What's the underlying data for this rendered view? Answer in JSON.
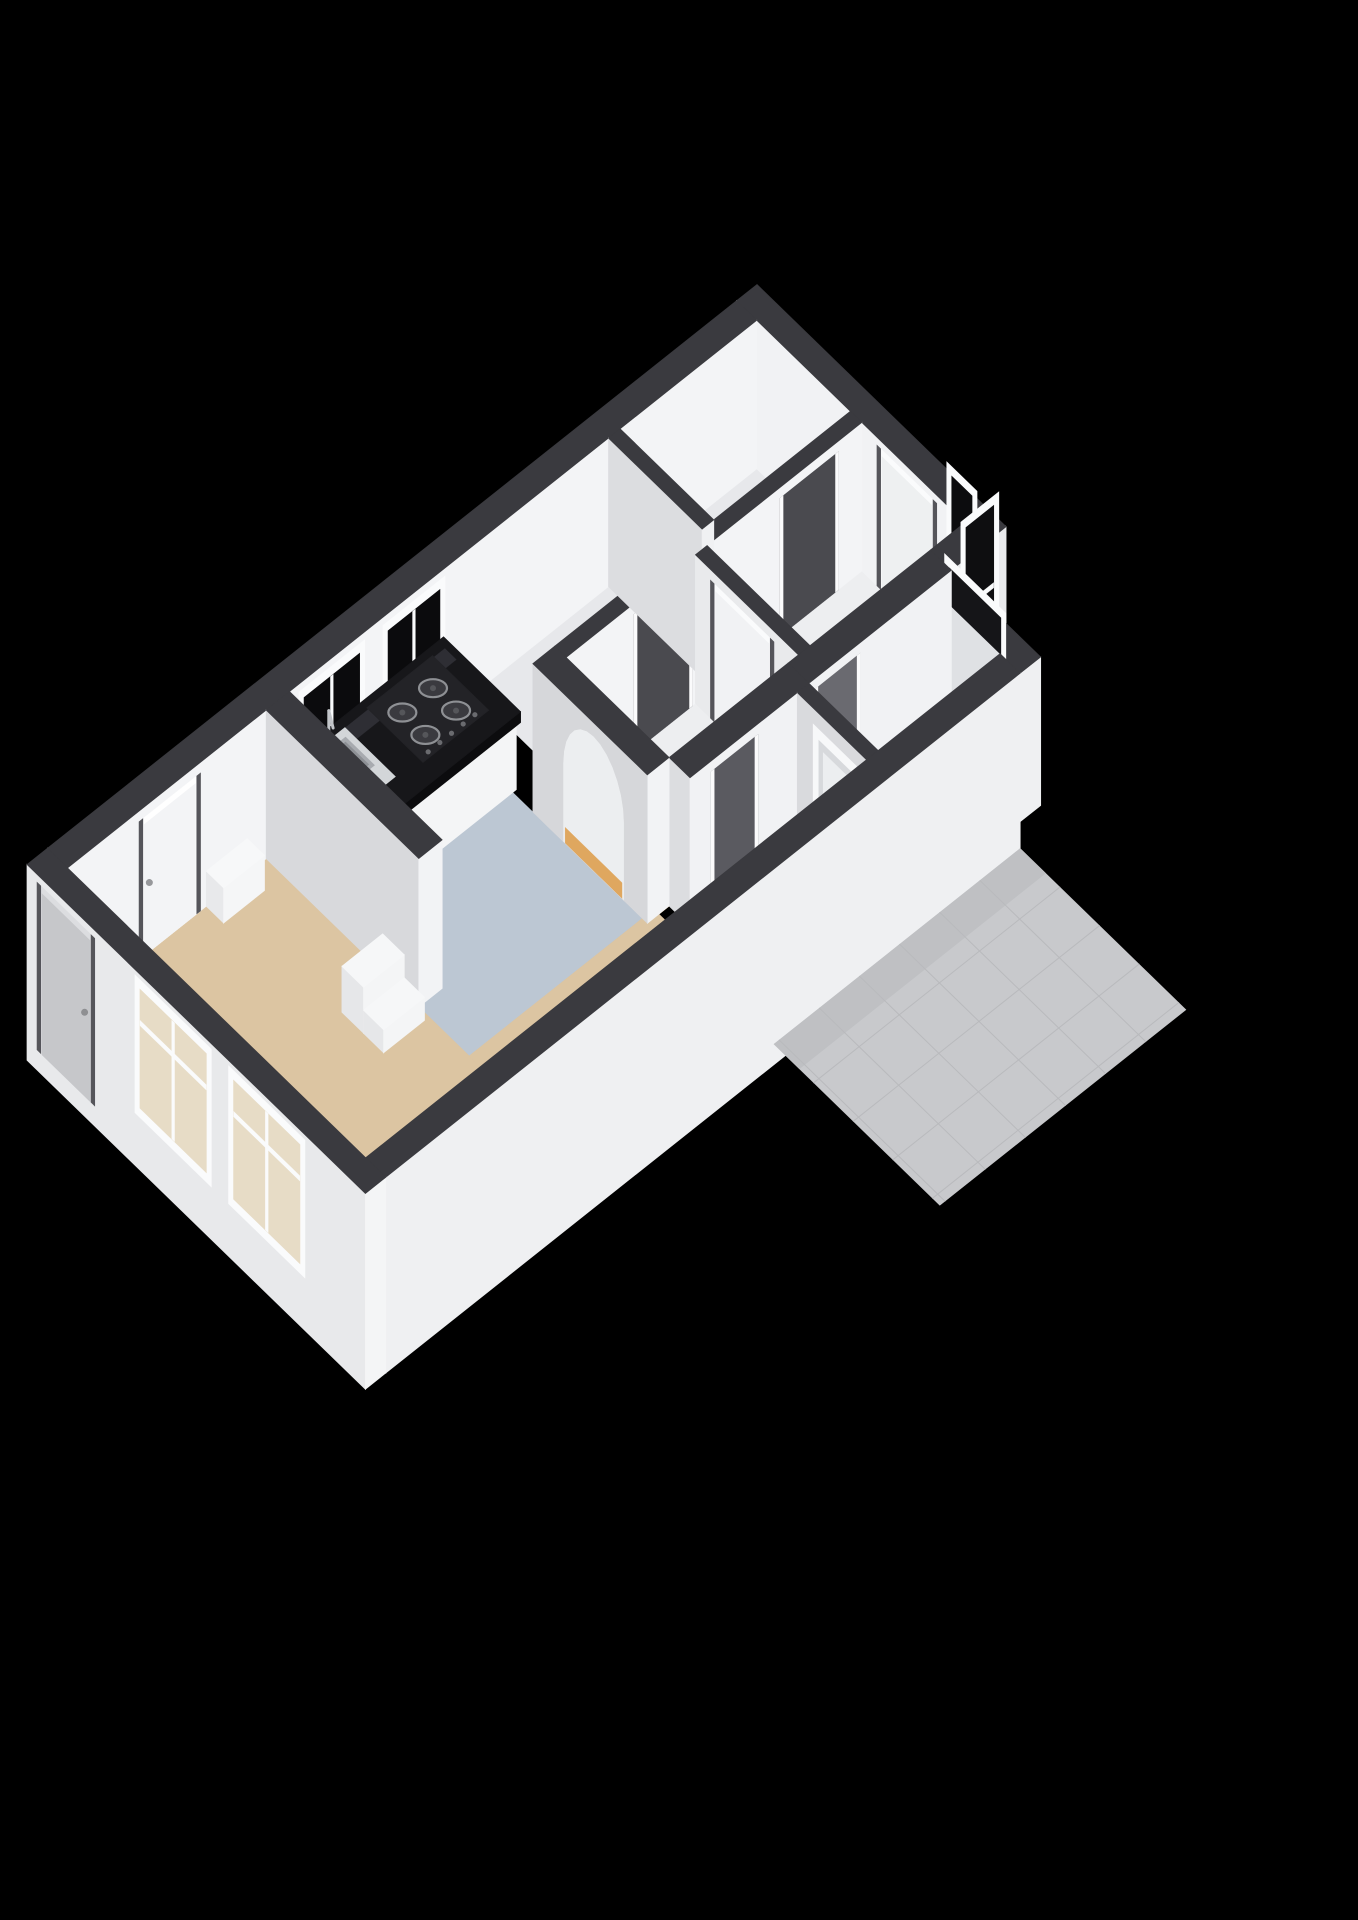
{
  "meta": {
    "description": "3D axonometric floor plan render of an elongated apartment on black background",
    "render_style": "cut-wall 3d floorplan"
  },
  "canvas": {
    "width": 1358,
    "height": 1920,
    "background": "#000000"
  },
  "projection": {
    "origin": [
      757,
      433
    ],
    "u_axis": [
      -0.73,
      0.58
    ],
    "v_axis": [
      0.72,
      0.7
    ],
    "z_scale": 1.35,
    "wall_height": 110
  },
  "palette": {
    "background": "#000000",
    "wall_cap": "#3a3a3f",
    "wall_sw_face": "#dadbde",
    "wall_se_face": "#f3f4f6",
    "floor_living": "#dcc5a2",
    "floor_kitchen": "#bcc7d3",
    "floor_hall_accent": "#dfa75f",
    "floor_neutral": "#edeef0",
    "floor_tile": "#e5e6e8",
    "counter_top": "#17171a",
    "glass_dark": "#0c0c0e",
    "glass_light": "#dfe1e4",
    "frame_white": "#fafbfc",
    "exterior_door": "#c6c7ca",
    "terrace_gray": "#c8c9cc"
  },
  "rooms": [
    {
      "name": "entrance-hall",
      "floor": "#edeef0"
    },
    {
      "name": "storage-closet",
      "floor": "#e7e8eb"
    },
    {
      "name": "storage-room",
      "floor": "#e7e8eb"
    },
    {
      "name": "hallway",
      "floor": "#edeef0",
      "accent": "#dfa75f"
    },
    {
      "name": "bathroom",
      "floor": "#e5e6e8",
      "finish": "tiles"
    },
    {
      "name": "utility-room",
      "floor": "#eceef0"
    },
    {
      "name": "kitchen",
      "floor": "#bcc7d3"
    },
    {
      "name": "living-room",
      "floor": "#dcc5a2"
    }
  ],
  "scene": {
    "elements": [
      {
        "name": "storage-closet-floor",
        "kind": "floor",
        "rect": [
          28,
          28,
          215,
          158
        ],
        "color": "#e7e8eb"
      },
      {
        "name": "storage-room-floor",
        "kind": "floor",
        "rect": [
          231,
          28,
          415,
          158
        ],
        "color": "#e7e8eb"
      },
      {
        "name": "entrance-hall-floor",
        "kind": "floor",
        "rect": [
          28,
          174,
          240,
          317
        ],
        "color": "#edeef0"
      },
      {
        "name": "hallway-floor",
        "kind": "floor",
        "rect": [
          256,
          174,
          433,
          317
        ],
        "color": "#edeef0"
      },
      {
        "name": "hallway-accent-floor",
        "kind": "floor",
        "rect": [
          380,
          174,
          463,
          317
        ],
        "color": "#dfa75f"
      },
      {
        "name": "bathroom-floor",
        "kind": "floor",
        "rect": [
          103,
          346,
          270,
          442
        ],
        "color": "#e5e6e8"
      },
      {
        "name": "bathroom-tile-grid",
        "kind": "tiles",
        "rect": [
          103,
          346,
          270,
          442
        ],
        "step": 26,
        "stroke": "#d4d5d8"
      },
      {
        "name": "utility-room-floor",
        "kind": "floor",
        "rect": [
          286,
          346,
          433,
          442
        ],
        "color": "#eceef0"
      },
      {
        "name": "kitchen-floor",
        "kind": "floor",
        "rect": [
          463,
          28,
          700,
          310
        ],
        "color": "#bcc7d3"
      },
      {
        "name": "living-room-floor",
        "kind": "floor",
        "rect": [
          700,
          28,
          972,
          442
        ],
        "color": "#dcc5a2"
      },
      {
        "name": "living-room-floor-wing",
        "kind": "floor",
        "rect": [
          447,
          310,
          700,
          442
        ],
        "color": "#dcc5a2"
      },
      {
        "name": "front-door-threshold",
        "kind": "floor",
        "rect": [
          0,
          195,
          28,
          278
        ],
        "color": "#3b3b40"
      },
      {
        "name": "closet-threshold",
        "kind": "floor",
        "rect": [
          60,
          158,
          140,
          174
        ],
        "color": "#3b3b40"
      },
      {
        "name": "storage-threshold",
        "kind": "floor",
        "rect": [
          260,
          158,
          340,
          174
        ],
        "color": "#3b3b40"
      },
      {
        "name": "hall-door-threshold",
        "kind": "floor",
        "rect": [
          240,
          195,
          256,
          283
        ],
        "color": "#3b3b40"
      },
      {
        "name": "bathroom-threshold",
        "kind": "floor",
        "rect": [
          200,
          330,
          262,
          346
        ],
        "color": "#3b3b40"
      },
      {
        "name": "utility-threshold",
        "kind": "floor",
        "rect": [
          340,
          317,
          404,
          346
        ],
        "color": "#3b3b40"
      },
      {
        "name": "northeast-end-wall",
        "kind": "wall",
        "rect": [
          0,
          0,
          28,
          345
        ],
        "h": 110,
        "cu": "#f1f2f4",
        "cv": "#e8e9eb",
        "cap": "#3a3a3f",
        "deco": [
          {
            "name": "front-door",
            "kind": "door",
            "face": "u",
            "t": [
              195,
              278
            ],
            "z": [
              0,
              104
            ],
            "frame": "#fafbfc",
            "panel": "#eef0f1",
            "handle": "#97989b"
          },
          {
            "name": "entry-window",
            "kind": "window",
            "face": "u",
            "t": [
              292,
              334
            ],
            "z": [
              10,
              142
            ],
            "frame": "#fafbfc",
            "glass": "#0c0c0e",
            "mz": 76
          }
        ]
      },
      {
        "name": "northwest-long-wall",
        "kind": "wall",
        "rect": [
          28,
          0,
          972,
          28
        ],
        "h": 110,
        "cu": "#dadbde",
        "cv": "#f3f4f6",
        "cap": "#3a3a3f",
        "deco": [
          {
            "name": "kitchen-window-1",
            "kind": "window",
            "face": "v",
            "t": [
              455,
              540
            ],
            "z": [
              28,
              104
            ],
            "frame": "#fafbfc",
            "glass": "#0b0b0d",
            "mt": true
          },
          {
            "name": "kitchen-window-2",
            "kind": "window",
            "face": "v",
            "t": [
              565,
              655
            ],
            "z": [
              28,
              104
            ],
            "frame": "#fafbfc",
            "glass": "#0b0b0d",
            "mt": true
          },
          {
            "name": "living-room-door",
            "kind": "door",
            "face": "v",
            "t": [
              790,
              874
            ],
            "z": [
              0,
              102
            ],
            "frame": "#ffffff",
            "panel": "#f3f4f6",
            "handle": "#97989b"
          }
        ]
      },
      {
        "name": "entry-block-side-wall",
        "kind": "wall",
        "rect": [
          0,
          317,
          75,
          346
        ],
        "h": 110,
        "cu": "#e2e3e6",
        "cv": "#e9eaec",
        "cap": "#3a3a3f",
        "deco": [
          {
            "name": "entry-side-window",
            "kind": "window",
            "face": "v",
            "t": [
              10,
              62
            ],
            "z": [
              8,
              140
            ],
            "frame": "#fafbfc",
            "glass": "#0e0e10",
            "mz": 74
          }
        ]
      },
      {
        "name": "bathroom-end-wall",
        "kind": "wall",
        "rect": [
          75,
          345,
          103,
          470
        ],
        "h": 110,
        "cu": "#f1f2f4",
        "cv": "#eff0f2",
        "cap": "#3a3a3f",
        "deco": [
          {
            "name": "bathroom-window",
            "kind": "window",
            "face": "u",
            "t": [
              365,
              450
            ],
            "z": [
              14,
              144
            ],
            "frame": "#fafbfc",
            "glass": "#dfe1e4",
            "split": 110,
            "topGlass": "#151518",
            "sill": true
          }
        ]
      },
      {
        "name": "storage-strip-wall",
        "kind": "wall",
        "rect": [
          28,
          158,
          433,
          174
        ],
        "h": 110,
        "cu": "#dadbde",
        "cv": "#f3f4f6",
        "cap": "#3a3a3f",
        "deco": [
          {
            "name": "closet-doorway",
            "kind": "opening",
            "face": "v",
            "t": [
              60,
              140
            ],
            "z": [
              0,
              102
            ],
            "color": "#4a4a4f"
          },
          {
            "name": "storage-doorway",
            "kind": "opening",
            "face": "v",
            "t": [
              260,
              340
            ],
            "z": [
              0,
              102
            ],
            "color": "#4a4a4f"
          }
        ]
      },
      {
        "name": "closet-divider-wall",
        "kind": "wall",
        "rect": [
          215,
          28,
          231,
          158
        ],
        "h": 110,
        "cu": "#dcdde0",
        "cv": "#f0f1f3",
        "cap": "#3a3a3f",
        "deco": []
      },
      {
        "name": "hall-divider-wall",
        "kind": "wall",
        "rect": [
          240,
          174,
          256,
          317
        ],
        "h": 110,
        "cu": "#e9eaec",
        "cv": "#f2f3f5",
        "cap": "#3a3a3f",
        "deco": [
          {
            "name": "hall-door",
            "kind": "door",
            "face": "u",
            "t": [
              195,
              283
            ],
            "z": [
              0,
              102
            ],
            "frame": "#fafbfc",
            "panel": "#f1f2f4",
            "handle": "#97989b"
          }
        ]
      },
      {
        "name": "bathroom-north-wall",
        "kind": "wall",
        "rect": [
          75,
          317,
          270,
          346
        ],
        "h": 110,
        "cu": "#dcdde0",
        "cv": "#f1f2f4",
        "cap": "#3a3a3f",
        "deco": [
          {
            "name": "bathroom-doorway",
            "kind": "opening",
            "face": "v",
            "t": [
              200,
              262
            ],
            "z": [
              0,
              102
            ],
            "color": "#6a6a70"
          }
        ]
      },
      {
        "name": "utility-north-wall",
        "kind": "wall",
        "rect": [
          270,
          317,
          433,
          346
        ],
        "h": 110,
        "cu": "#dcdde0",
        "cv": "#f1f2f4",
        "cap": "#3a3a3f",
        "deco": [
          {
            "name": "utility-doorway",
            "kind": "opening",
            "face": "v",
            "t": [
              340,
              404
            ],
            "z": [
              0,
              102
            ],
            "color": "#5a5a60"
          }
        ]
      },
      {
        "name": "bathroom-divider-wall",
        "kind": "wall",
        "rect": [
          270,
          346,
          286,
          442
        ],
        "h": 110,
        "cu": "#d9dadd",
        "cv": "#f0f1f3",
        "cap": "#3a3a3f",
        "deco": [
          {
            "name": "utility-recessed-window",
            "kind": "recess",
            "face": "u",
            "t": [
              368,
              428
            ],
            "z": [
              26,
              98
            ]
          }
        ]
      },
      {
        "name": "arch-wall",
        "kind": "archwall",
        "rect": [
          433,
          158,
          463,
          317
        ],
        "h": 110,
        "cu": "#d6d7da",
        "cv": "#f2f3f5",
        "cap": "#3a3a3f",
        "arch": {
          "t": [
            200,
            285
          ],
          "jamb": 58,
          "apex": 100,
          "backdrop": "#eceef0",
          "floor": "#dfa75f"
        }
      },
      {
        "name": "kitchen-counter-base",
        "kind": "wall",
        "rect": [
          458,
          28,
          662,
          130
        ],
        "h": 50,
        "cu": "#eef0f2",
        "cv": "#f4f5f6",
        "cap": "#f4f5f6",
        "deco": []
      },
      {
        "name": "kitchen-counter-top",
        "kind": "slab",
        "rect": [
          455,
          26,
          665,
          133
        ],
        "z": [
          50,
          58
        ],
        "top": "#17171a",
        "lipu": "#0f0f11",
        "lipv": "#0c0c0e",
        "sheen": "#2e2e34"
      },
      {
        "name": "gas-hob",
        "kind": "hob",
        "rect": [
          478,
          34,
          568,
          112
        ],
        "z": 58,
        "tray": "#232327",
        "ring": "#8e9094",
        "burner": "#3a3a3f",
        "dot": "#55565a",
        "knob": "#6a6b6f"
      },
      {
        "name": "kitchen-sink",
        "kind": "sink",
        "rect": [
          600,
          36,
          652,
          106
        ],
        "z": 58,
        "rim": "#d3d6d9",
        "basin": "#a7aaaf",
        "well": "#8d9095",
        "tap": "#c2c5c9"
      },
      {
        "name": "kitchen-living-wall",
        "kind": "wall",
        "rect": [
          668,
          28,
          700,
          240
        ],
        "h": 110,
        "cu": "#d8d9dc",
        "cv": "#f2f3f5",
        "cap": "#3a3a3f",
        "deco": []
      },
      {
        "name": "living-step-unit-high",
        "kind": "wall",
        "rect": [
          706,
          196,
          762,
          226
        ],
        "h": 34,
        "cu": "#e6e7e9",
        "cv": "#f4f5f6",
        "cap": "#f6f7f8",
        "deco": []
      },
      {
        "name": "living-step-unit-low",
        "kind": "wall",
        "rect": [
          706,
          226,
          762,
          254
        ],
        "h": 17,
        "cu": "#e6e7e9",
        "cv": "#f4f5f6",
        "cap": "#f6f7f8",
        "deco": []
      },
      {
        "name": "living-wall-ledge",
        "kind": "wall",
        "rect": [
          726,
          28,
          782,
          52
        ],
        "h": 26,
        "cu": "#e8e9eb",
        "cv": "#f5f6f7",
        "cap": "#f7f8f9",
        "deco": []
      },
      {
        "name": "southeast-long-wall",
        "kind": "wall",
        "rect": [
          103,
          442,
          972,
          470
        ],
        "h": 110,
        "zb": -35,
        "cu": "#e5e6e8",
        "cv": "#eff0f2",
        "cap": "#3a3a3f",
        "deco": []
      },
      {
        "name": "terrace-slab",
        "kind": "polyfloor",
        "z": -20,
        "pts": [
          [
            103,
            470
          ],
          [
            440,
            470
          ],
          [
            440,
            700
          ],
          [
            103,
            700
          ]
        ],
        "color": "#c8c9cc"
      },
      {
        "name": "terrace-edge-strip",
        "kind": "polyfloor",
        "z": -20,
        "pts": [
          [
            103,
            470
          ],
          [
            440,
            470
          ],
          [
            440,
            505
          ],
          [
            103,
            505
          ]
        ],
        "color": "#bfc0c3"
      },
      {
        "name": "terrace-tile-grid",
        "kind": "tiles",
        "rect": [
          103,
          470,
          440,
          700
        ],
        "step": 55,
        "stroke": "#b9babd",
        "z": -20
      },
      {
        "name": "southwest-end-wall",
        "kind": "wall",
        "rect": [
          972,
          0,
          1000,
          470
        ],
        "h": 110,
        "zb": -35,
        "cu": "#e8e9eb",
        "cv": "#f4f5f6",
        "cap": "#3a3a3f",
        "deco": [
          {
            "name": "exterior-door",
            "kind": "door",
            "face": "u",
            "t": [
              14,
              94
            ],
            "z": [
              -20,
              104
            ],
            "frame": "#dcdde0",
            "panel": "#c6c7ca",
            "handle": "#8e8f92"
          },
          {
            "name": "living-window-1",
            "kind": "window",
            "face": "u",
            "t": [
              150,
              256
            ],
            "z": [
              4,
              106
            ],
            "frame": "#fafbfc",
            "glass": "#e7dcc6",
            "mt": true,
            "mz": 74
          },
          {
            "name": "living-window-2",
            "kind": "window",
            "face": "u",
            "t": [
              280,
              386
            ],
            "z": [
              4,
              106
            ],
            "frame": "#fafbfc",
            "glass": "#e7dcc6",
            "mt": true,
            "mz": 74
          }
        ]
      }
    ]
  }
}
